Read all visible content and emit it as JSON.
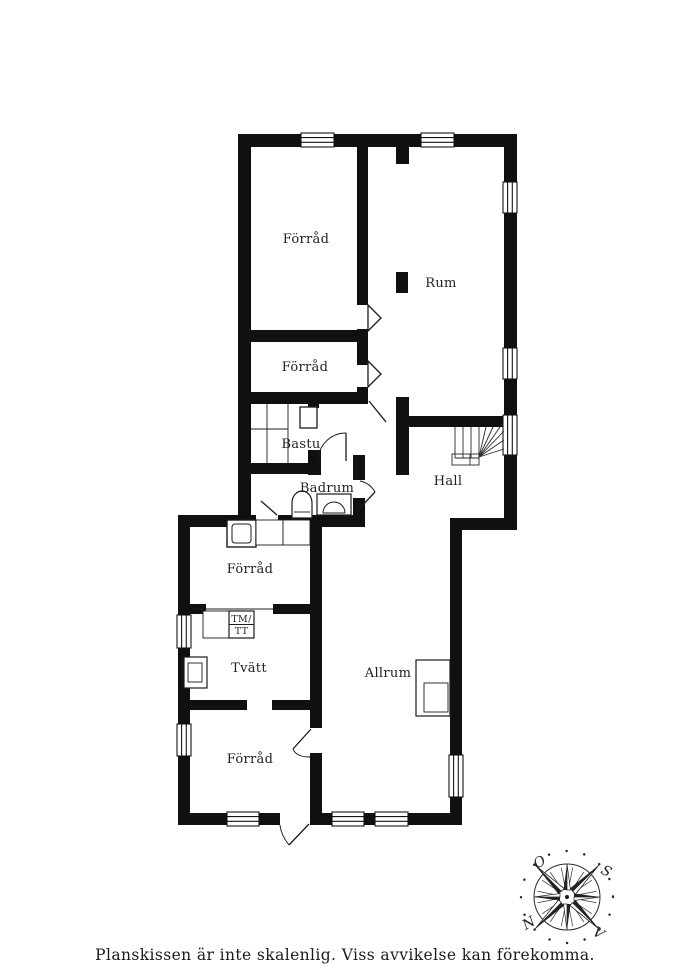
{
  "caption": "Planskissen är inte skalenlig. Viss avvikelse kan förekomma.",
  "rooms": {
    "forrad_top": "Förråd",
    "rum": "Rum",
    "forrad_mid": "Förråd",
    "bastu": "Bastu",
    "badrum": "Badrum",
    "hall": "Hall",
    "forrad_left": "Förråd",
    "tvatt": "Tvätt",
    "allrum": "Allrum",
    "forrad_bottom": "Förråd"
  },
  "appliances": {
    "washer_label": "TM/",
    "dryer_label": "TT"
  },
  "compass": {
    "east": "O",
    "south": "S",
    "north": "N",
    "west": "V"
  },
  "colors": {
    "wall": "#101010",
    "line": "#1f1f1f",
    "background": "#ffffff"
  }
}
